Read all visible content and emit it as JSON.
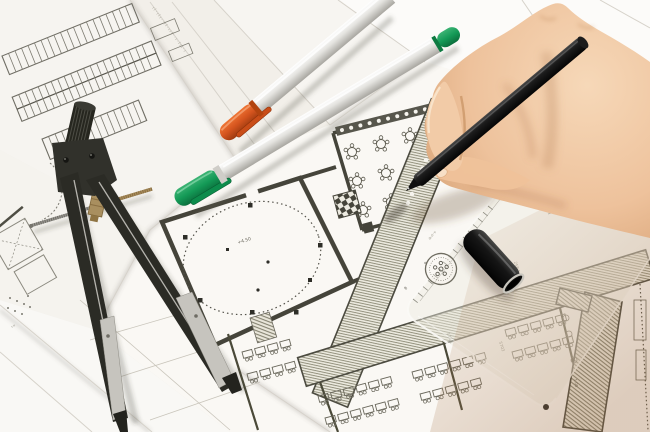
{
  "meta": {
    "subject": "Photograph: architect's hand drawing with a black pen over architectural floor plans, with a divider compass, orange- and green-capped pens, a black pen cap and a transparent set-square ruler"
  },
  "palette": {
    "paper": "#f7f5f1",
    "ink": "#4a4938",
    "ink_light": "#85837a",
    "orange_cap": "#d4541e",
    "green_cap": "#149a57",
    "skin": "#eec29c",
    "skin_shadow": "#b07a4e",
    "metal": "#c6c4be",
    "pen_black": "#121210",
    "brass": "#a98f5f"
  },
  "labels": {
    "elevation": "+4.50",
    "dim_a": "5703",
    "dim_b": "258.1",
    "dim_c": "175.1",
    "note": "1.05",
    "scale_8": "8",
    "scale_9": "9",
    "sheet_note": "ıl·ılı··ıl·ııl··ı·lıı·ı",
    "ruler_marking": "ılı·ıl··ıı",
    "plan_note": "ı·ıı"
  }
}
